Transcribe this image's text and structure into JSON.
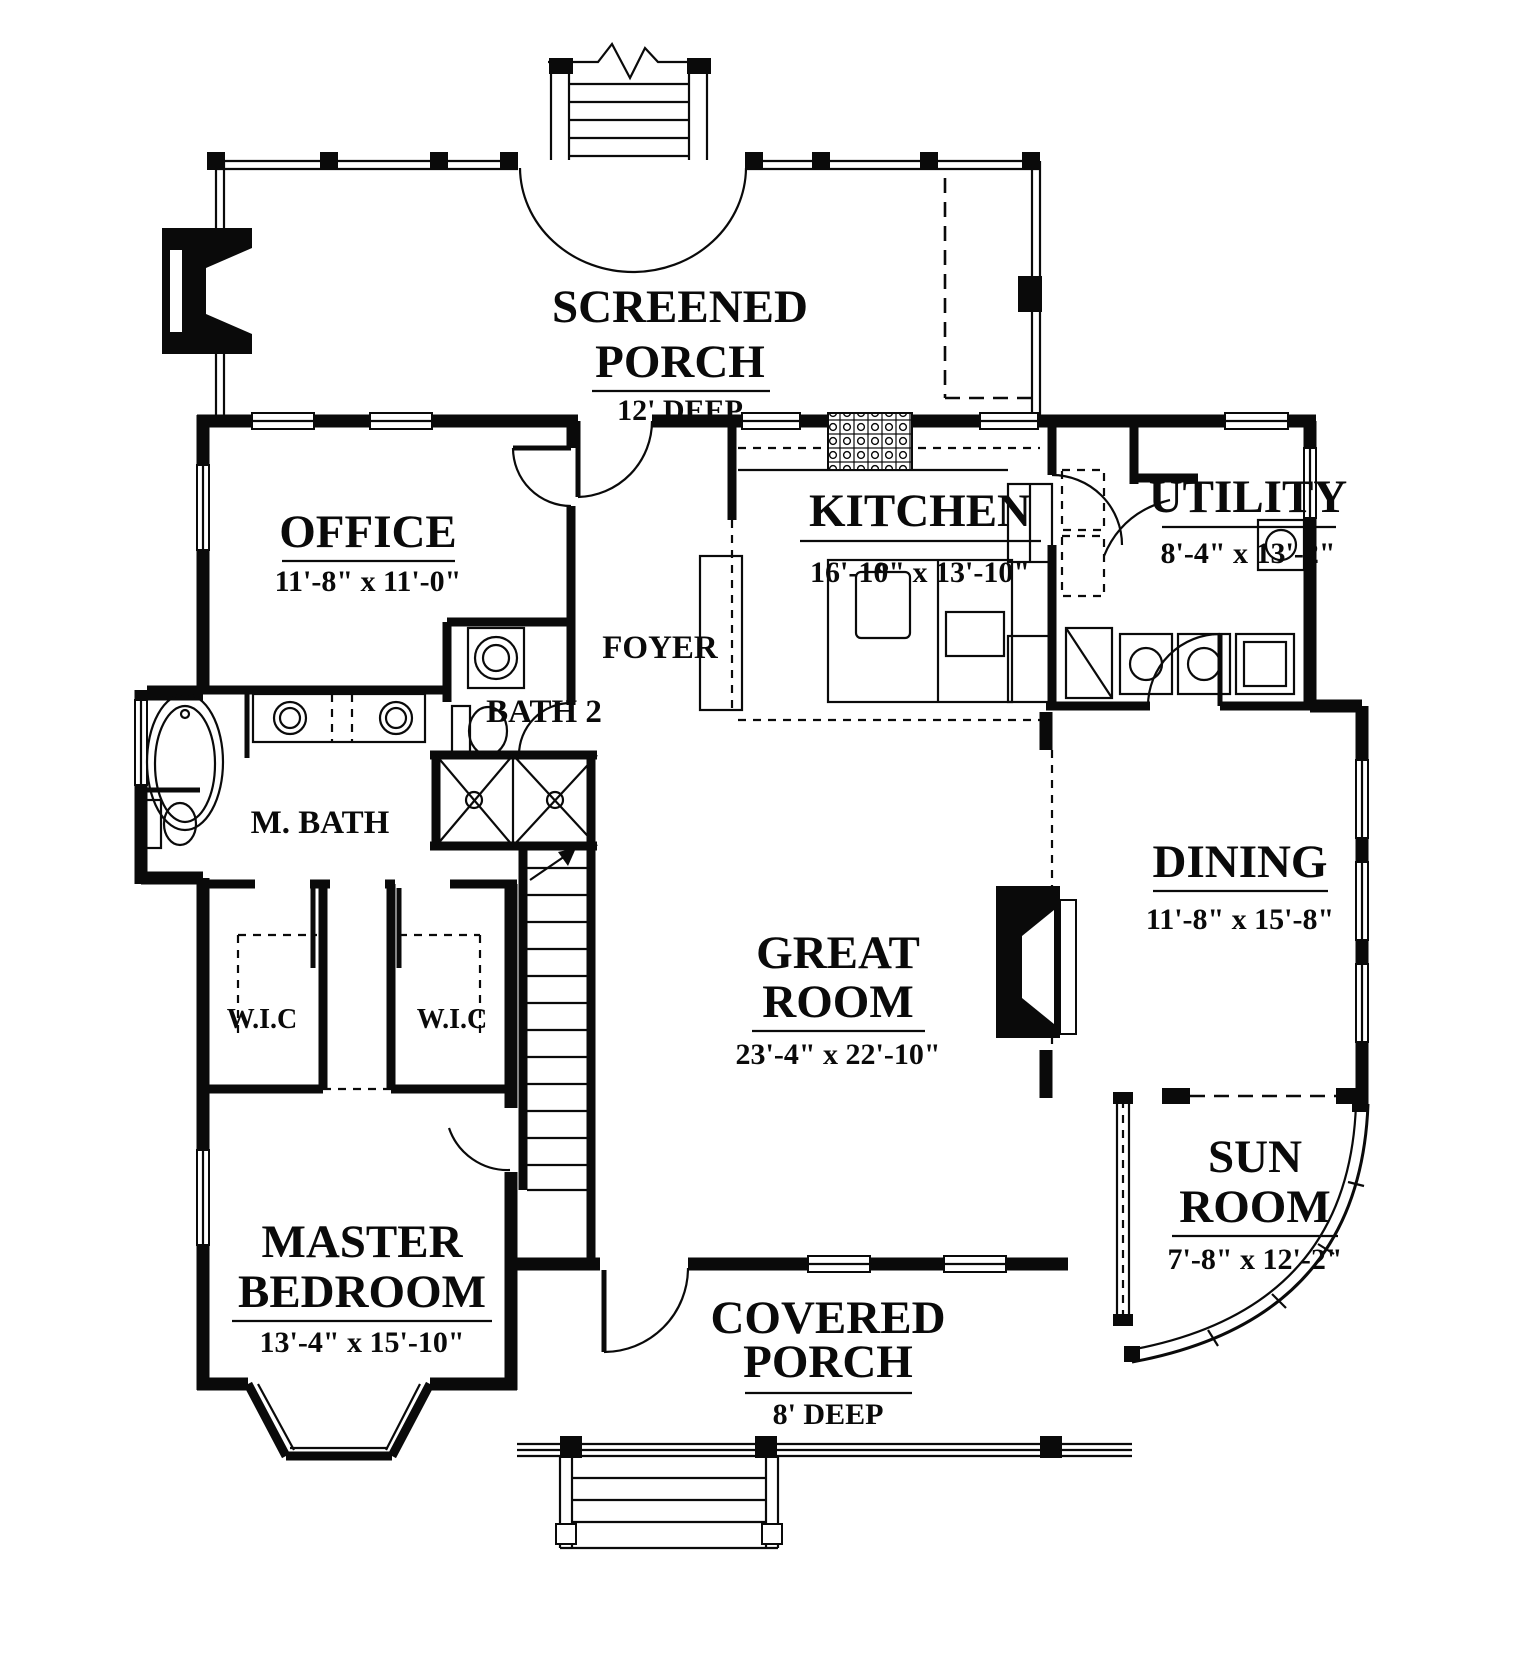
{
  "document": {
    "kind": "architectural-floor-plan",
    "ink_color": "#0a0a0a",
    "paper_color": "#ffffff"
  },
  "rooms": {
    "screened_porch": {
      "line1": "SCREENED",
      "line2": "PORCH",
      "dim": "12' DEEP"
    },
    "office": {
      "name": "OFFICE",
      "dim": "11'-8\" x 11'-0\""
    },
    "kitchen": {
      "name": "KITCHEN",
      "dim": "16'-10\" x 13'-10\""
    },
    "utility": {
      "name": "UTILITY",
      "dim": "8'-4\" x 13'-2\""
    },
    "foyer": {
      "name": "FOYER"
    },
    "bath2": {
      "name": "BATH 2"
    },
    "master_bath": {
      "name": "M. BATH"
    },
    "great_room": {
      "line1": "GREAT",
      "line2": "ROOM",
      "dim": "23'-4\" x 22'-10\""
    },
    "dining": {
      "name": "DINING",
      "dim": "11'-8\" x 15'-8\""
    },
    "wic_left": {
      "name": "W.I.C"
    },
    "wic_right": {
      "name": "W.I.C"
    },
    "sun_room": {
      "line1": "SUN",
      "line2": "ROOM",
      "dim": "7'-8\" x 12'-2\""
    },
    "master_bedroom": {
      "line1": "MASTER",
      "line2": "BEDROOM",
      "dim": "13'-4\" x 15'-10\""
    },
    "covered_porch": {
      "line1": "COVERED",
      "line2": "PORCH",
      "dim": "8' DEEP"
    }
  }
}
